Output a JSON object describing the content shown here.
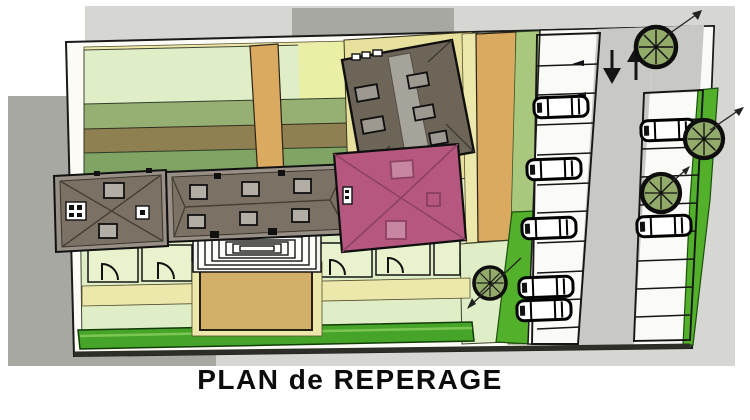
{
  "title": "PLAN de REPERAGE",
  "plan": {
    "kind": "architectural-site-location-plan",
    "highlighted_building": "pink-hip-roof-building",
    "symbols": [
      "hip-roof-building",
      "tilted-dark-roof-building",
      "stepped-terrace",
      "courtyard",
      "garden-plot",
      "gate-swing",
      "hedge",
      "lawn",
      "parking-bay",
      "car",
      "tree",
      "two-way-traffic-arrows",
      "leader-arrow"
    ],
    "counts": {
      "cars": 7,
      "trees": 4,
      "traffic_arrows": 2,
      "buildings": 4
    }
  },
  "colors": {
    "backdrop": "#d6d6d3",
    "backdrop-shadow": "#a8a8a2",
    "plate": "#fcfbf5",
    "lawn": "#dfeec6",
    "lawn-mid": "#96b074",
    "band-green": "#7fa464",
    "olive-road": "#8e8050",
    "tan-road": "#d9aa60",
    "courtyard-tan": "#d3b069",
    "pale-yellow": "#ece7ab",
    "khaki": "#e7e19d",
    "hedge-green": "#46a528",
    "bright-green": "#53b02a",
    "strip-green": "#a9c87d",
    "roof-brown": "#7b7265",
    "roof-eave": "#989086",
    "roof-dark": "#6d6558",
    "roof-strip": "#a6a39b",
    "skylight": "#b2aea5",
    "building-pink": "#b5577e",
    "pink-ridge": "#8e4263",
    "parking-lane": "#c8c8c4",
    "parking-white": "#fafaf6",
    "tree-green": "#93ab6a",
    "line": "#141414"
  }
}
